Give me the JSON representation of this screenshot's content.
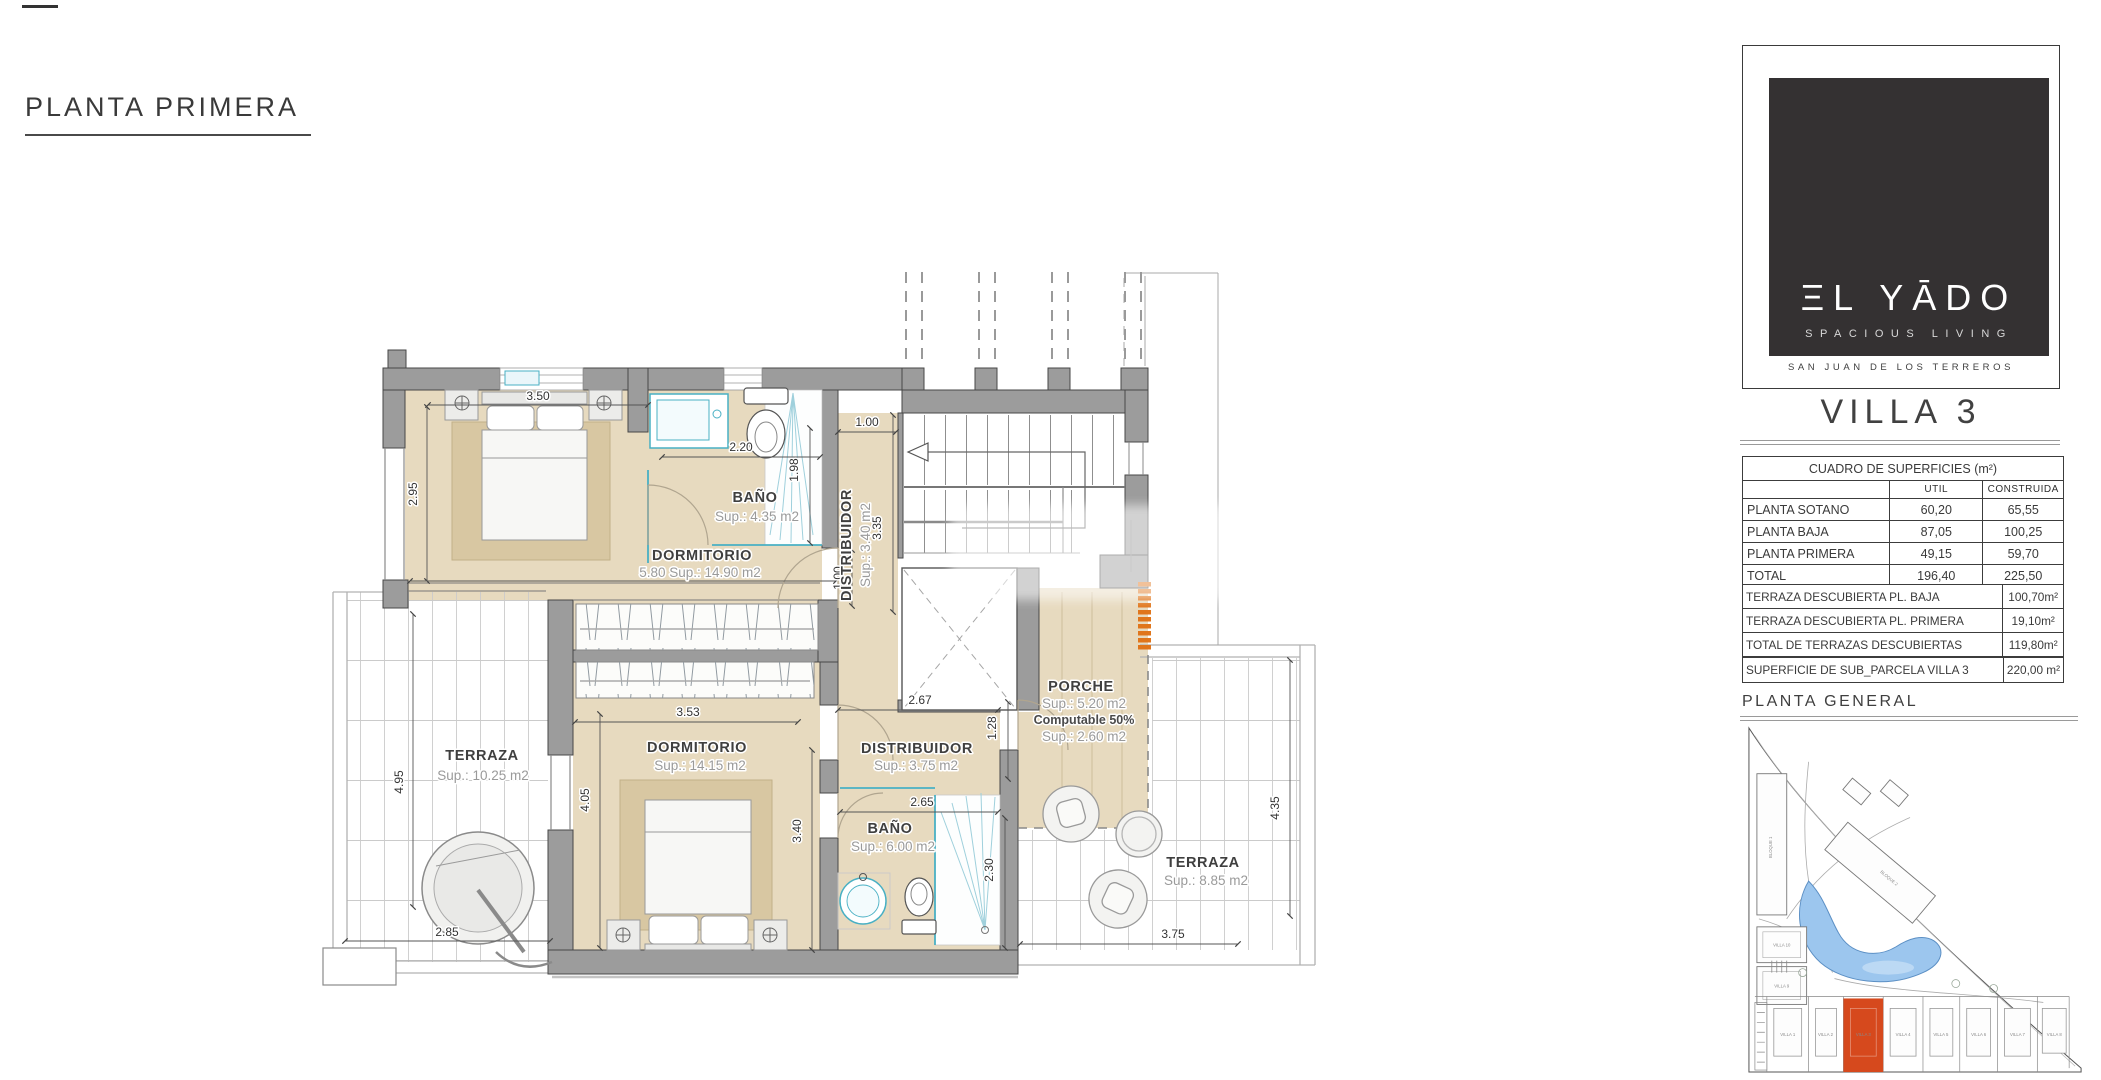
{
  "page": {
    "plan_title": "PLANTA PRIMERA"
  },
  "plan": {
    "rooms": {
      "dorm1": {
        "name": "DORMITORIO",
        "line2": "5.80   Sup.: 14.90  m2"
      },
      "bano1": {
        "name": "BAÑO",
        "sup": "Sup.: 4.35   m2"
      },
      "dist1": {
        "name": "DISTRIBUIDOR",
        "sup": "Sup.: 3.40  m2"
      },
      "dorm2": {
        "name": "DORMITORIO",
        "sup": "Sup.: 14.15  m2"
      },
      "dist2": {
        "name": "DISTRIBUIDOR",
        "sup": "Sup.: 3.75   m2"
      },
      "bano2": {
        "name": "BAÑO",
        "sup": "Sup.: 6.00   m2"
      },
      "terraza1": {
        "name": "TERRAZA",
        "sup": "Sup.: 10.25  m2"
      },
      "terraza2": {
        "name": "TERRAZA",
        "sup": "Sup.: 8.85   m2"
      },
      "porche": {
        "name": "PORCHE",
        "sup1": "Sup.: 5.20   m2",
        "note": "Computable 50%",
        "sup2": "Sup.: 2.60   m2"
      }
    },
    "dims": {
      "d350": "3.50",
      "d295": "2.95",
      "d220": "2.20",
      "d198": "1.98",
      "d100a": "1.00",
      "d335": "3.35",
      "d100b": "1.00",
      "d353": "3.53",
      "d405": "4.05",
      "d267": "2.67",
      "d128": "1.28",
      "d265": "2.65",
      "d340": "3.40",
      "d230": "2.30",
      "d495": "4.95",
      "d285": "2.85",
      "d435": "4.35",
      "d375": "3.75"
    }
  },
  "sidebar": {
    "logo": {
      "brand": "ΞL YĀDO",
      "tagline": "SPACIOUS LIVING",
      "location": "SAN JUAN DE LOS TERREROS"
    },
    "villa_title": "VILLA 3",
    "surfaces": {
      "title": "CUADRO DE SUPERFICIES (m²)",
      "col_util": "UTIL",
      "col_construida": "CONSTRUIDA",
      "rows": [
        {
          "label": "PLANTA SOTANO",
          "util": "60,20",
          "construida": "65,55"
        },
        {
          "label": "PLANTA BAJA",
          "util": "87,05",
          "construida": "100,25"
        },
        {
          "label": "PLANTA PRIMERA",
          "util": "49,15",
          "construida": "59,70"
        },
        {
          "label": "TOTAL",
          "util": "196,40",
          "construida": "225,50"
        }
      ]
    },
    "terraces": {
      "rows": [
        {
          "label": "TERRAZA DESCUBIERTA PL. BAJA",
          "value": "100,70m²"
        },
        {
          "label": "TERRAZA DESCUBIERTA PL. PRIMERA",
          "value": "19,10m²"
        },
        {
          "label": "TOTAL DE TERRAZAS DESCUBIERTAS",
          "value": "119,80m²"
        }
      ]
    },
    "parcel": {
      "label": "SUPERFICIE DE SUB_PARCELA VILLA 3",
      "value": "220,00 m²"
    },
    "general_title": "PLANTA GENERAL",
    "site": {
      "villas": [
        "VILLA 1",
        "VILLA 2",
        "VILLA 3",
        "VILLA 4",
        "VILLA 5",
        "VILLA 6",
        "VILLA 7",
        "VILLA 8"
      ],
      "left_villas": [
        "VILLA 10",
        "VILLA 9"
      ],
      "blocks": [
        "BLOQUE 1",
        "BLOQUE 2"
      ],
      "highlight_color": "#d6491d"
    }
  }
}
